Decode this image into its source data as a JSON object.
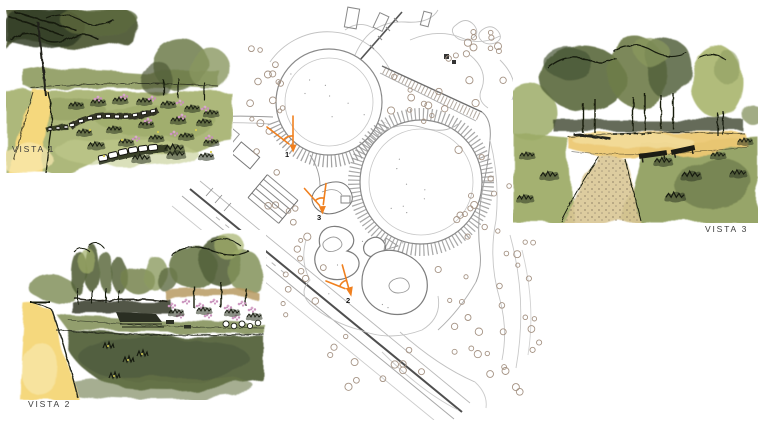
{
  "vistas": [
    {
      "label": "VISTA 1"
    },
    {
      "label": "VISTA 2"
    },
    {
      "label": "VISTA 3"
    }
  ],
  "plan": {
    "markers": [
      {
        "number": "1"
      },
      {
        "number": "2"
      },
      {
        "number": "3"
      }
    ],
    "marker_color": "#f0801f"
  },
  "palette": {
    "path_yellow": "#f5d87d",
    "lawn_olive": "#a9b474",
    "lawn_dark": "#55633c",
    "foliage_dark": "#45502f",
    "foliage_mid": "#75834e",
    "foliage_light": "#a5b26c",
    "flower_pink": "#cf9ac2",
    "plan_line": "#9a9a9a",
    "tree_ring": "#a59384",
    "ink": "#1c2014",
    "label_color": "#3c3c3c"
  }
}
